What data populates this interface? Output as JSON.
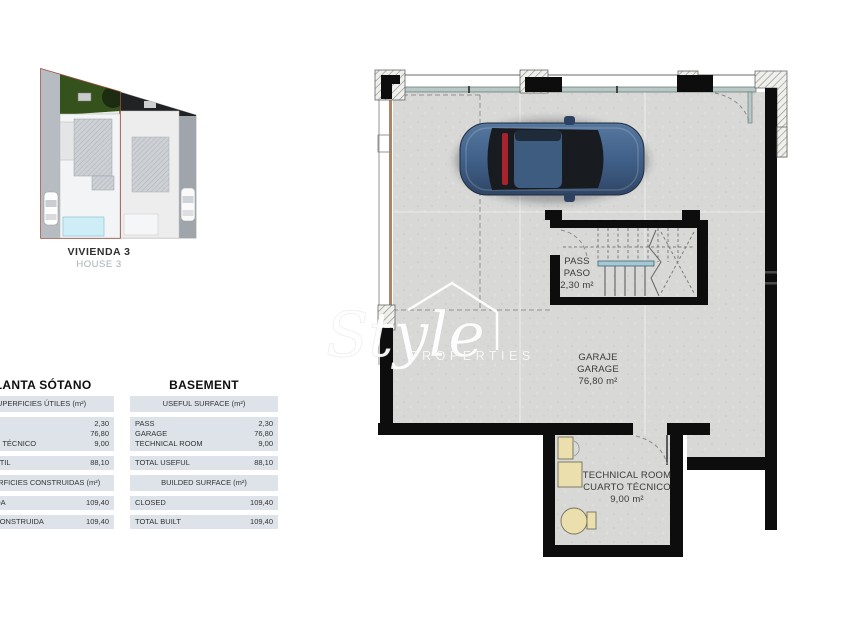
{
  "site_plan": {
    "label_primary": "VIVIENDA 3",
    "label_secondary": "HOUSE 3"
  },
  "tables": {
    "left": {
      "title": "PLANTA SÓTANO",
      "useful_header": "SUPERFICIES ÚTILES (m²)",
      "row_pass_label": "PASO",
      "row_pass_value": "2,30",
      "row_garage_label": "GARAJE",
      "row_garage_value": "76,80",
      "row_tech_label": "CUARTO TÉCNICO",
      "row_tech_value": "9,00",
      "total_useful_label": "TOTAL ÚTIL",
      "total_useful_value": "88,10",
      "built_header": "SUPERFICIES CONSTRUIDAS (m²)",
      "closed_label": "CERRADA",
      "closed_value": "109,40",
      "total_built_label": "TOTAL CONSTRUIDA",
      "total_built_value": "109,40"
    },
    "right": {
      "title": "BASEMENT",
      "useful_header": "USEFUL SURFACE (m²)",
      "row_pass_label": "PASS",
      "row_pass_value": "2,30",
      "row_garage_label": "GARAGE",
      "row_garage_value": "76,80",
      "row_tech_label": "TECHNICAL ROOM",
      "row_tech_value": "9,00",
      "total_useful_label": "TOTAL USEFUL",
      "total_useful_value": "88,10",
      "built_header": "BUILDED SURFACE (m²)",
      "closed_label": "CLOSED",
      "closed_value": "109,40",
      "total_built_label": "TOTAL BUILT",
      "total_built_value": "109,40"
    }
  },
  "plan": {
    "pass": {
      "line1": "PASS",
      "line2": "PASO",
      "area": "2,30 m²"
    },
    "garage": {
      "line1": "GARAJE",
      "line2": "GARAGE",
      "area": "76,80 m²"
    },
    "technical": {
      "line1": "TECHNICAL ROOM",
      "line2": "CUARTO TÉCNICO",
      "area": "9,00 m²"
    }
  },
  "watermark": {
    "script": "Style",
    "word": "PROPERTIES"
  },
  "colors": {
    "wall": "#0d0d0d",
    "floor": "#d8d9d6",
    "glass_teal": "#b7c8c5",
    "plot_outline": "#9c4f3f",
    "pool": "#cdeef6",
    "equipment": "#ecdfae",
    "car_blue": "#41618a",
    "brake_red": "#a8232b",
    "table_band": "#dde3e9",
    "ramp_brown": "#ad8465"
  }
}
